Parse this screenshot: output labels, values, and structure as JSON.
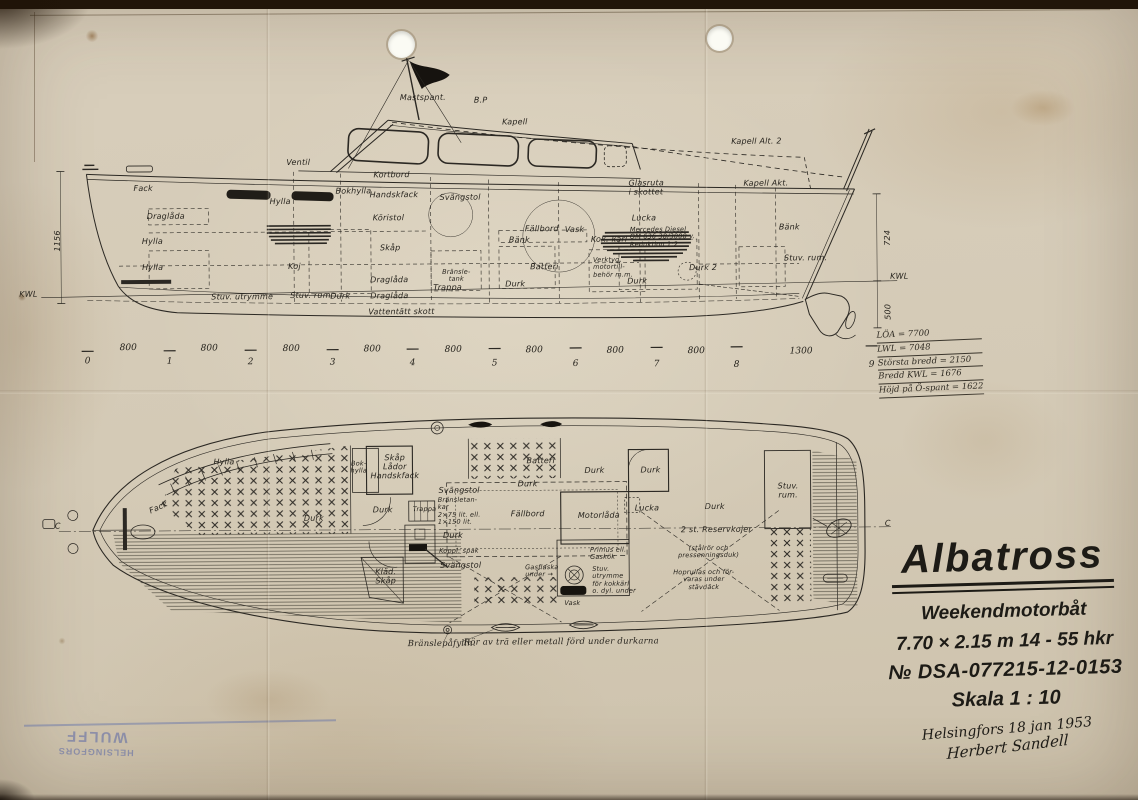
{
  "colors": {
    "paper": "#d5cbb7",
    "ink": "#2b2823",
    "stamp_blue": "#5a67a6"
  },
  "terms": {
    "durk": "Durk",
    "hylla": "Hylla",
    "fack": "Fack",
    "draglada": "Draglåda",
    "koj": "Koj",
    "lucka": "Lucka",
    "vask": "Vask",
    "bank": "Bänk",
    "batteri": "Batteri",
    "skap": "Skåp",
    "trappa": "Trappa",
    "svangstol": "Svängstol",
    "fallbord": "Fällbord",
    "handskfack": "Handskfack",
    "bokhylla": "Bokhylla",
    "kortbord": "Kortbord",
    "ventil": "Ventil",
    "kwl": "KWL",
    "section_c": "C",
    "stuv_utrymme": "Stuv. utrymme",
    "stuv_rum": "Stuv. rum."
  },
  "side_view": {
    "mastspant": "Mastspant.",
    "bp": "B.P",
    "kapell": "Kapell",
    "kapell_alt2": "Kapell Alt. 2",
    "kapell_akt": "Kapell Akt.",
    "koristol": "Köristol",
    "glasruta": "Glasruta\ni skottet",
    "mercedes": "Mercedes Diesel\nOM 636  38/3000 v.\nReduktion 1:2",
    "bransletank": "Bränsle-\ntank",
    "kok_karl": "Kok. kärl",
    "verktyg": "Verktyg,\nmotortill-\nbehör m.m.",
    "durk2": "Durk 2",
    "vattentatt_skott": "Vattentätt skott",
    "dim_724": "724",
    "dim_500": "500",
    "dim_1156": "1156"
  },
  "stations": {
    "numbers": [
      "0",
      "1",
      "2",
      "3",
      "4",
      "5",
      "6",
      "7",
      "8",
      "9"
    ],
    "gap": "800",
    "gap_last": "1300"
  },
  "specs": {
    "rows": [
      "LÖA = 7700",
      "LWL = 7048",
      "Största bredd = 2150",
      "Bredd KWL = 1676",
      "Höjd på Ö-spant = 1622"
    ]
  },
  "plan_view": {
    "skap_lador": "Skåp\nLådor\nHandskfack",
    "bok_hylla": "Bok-\nhylla",
    "bransletankar": "Bränsletan-\nkar\n2×75 lit. ell.\n1×150 lit.",
    "koppl_spak": "Koppl. spak",
    "klad_skap": "Kläd.\nSkåp",
    "motorlada": "Motorlåda",
    "primus": "Primus ell.\nGaskök",
    "gasflaska": "Gasflaska\nunder →",
    "stuv_kokkarl": "Stuv.\nutrymme\nför kokkärl\no. dyl. under",
    "stuv_rum": "Stuv.\nrum.",
    "reservkojer": "2 st. Reservkojer",
    "stalror": "(stålrör och\npressenningsduk)",
    "hoprullas": "Hoprullas och för-\nvaras under\nstävdäck",
    "branslepafylln": "Bränslepåfylln.",
    "ror_note": "Rör av trä eller metall förd under durkarna"
  },
  "title_block": {
    "name": "Albatross",
    "type": "Weekendmotorbåt",
    "size": "7.70 × 2.15 m   14 - 55 hkr",
    "number": "№ DSA-077215-12-0153",
    "scale": "Skala 1 : 10",
    "place_date": "Helsingfors 18 jan 1953",
    "signature": "Herbert Sandell"
  },
  "stamp": {
    "line1": "WULFF",
    "line2": "HELSINGFORS"
  }
}
